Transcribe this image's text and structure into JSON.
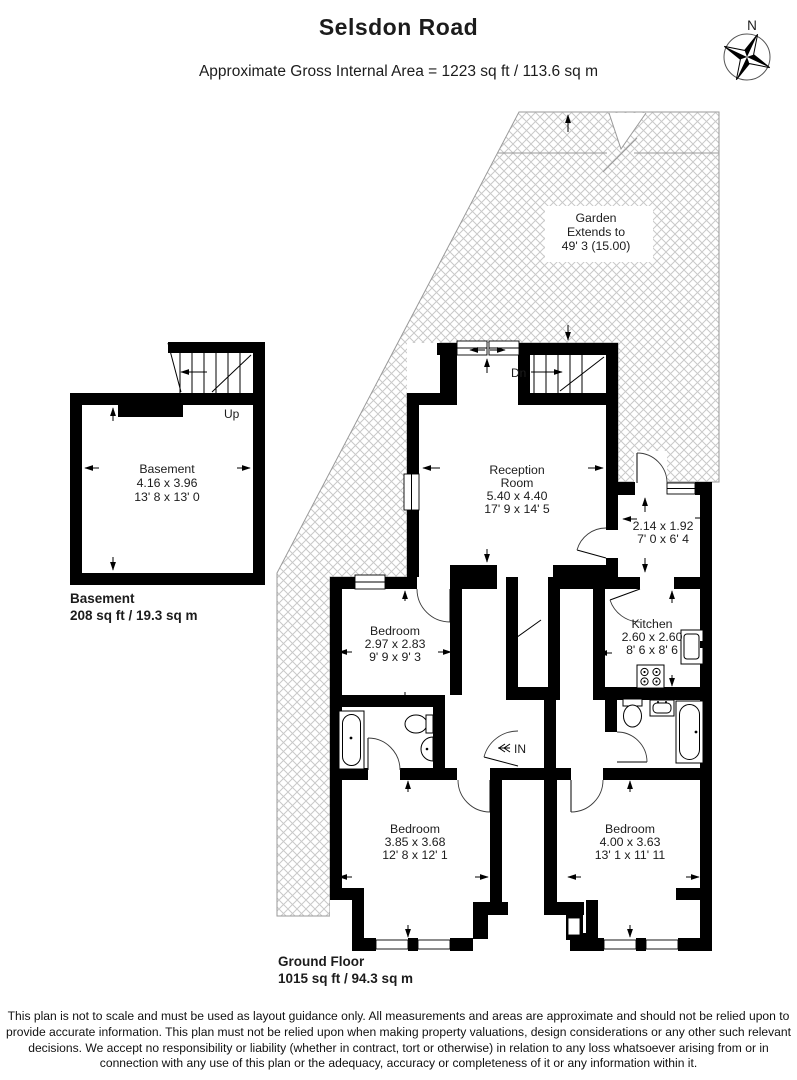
{
  "page": {
    "title": "Selsdon Road",
    "subtitle": "Approximate Gross Internal Area = 1223 sq ft / 113.6 sq m"
  },
  "compass": {
    "north": "N"
  },
  "garden": {
    "line1": "Garden",
    "line2": "Extends to",
    "line3": "49' 3 (15.00)"
  },
  "rooms": {
    "reception": {
      "line1": "Reception",
      "line2": "Room",
      "metric": "5.40 x 4.40",
      "imperial": "17' 9 x 14' 5"
    },
    "hallway": {
      "metric": "2.14 x 1.92",
      "imperial": "7' 0 x 6' 4"
    },
    "kitchen": {
      "name": "Kitchen",
      "metric": "2.60 x 2.60",
      "imperial": "8' 6 x 8' 6"
    },
    "bedroom_mid": {
      "name": "Bedroom",
      "metric": "2.97 x 2.83",
      "imperial": "9' 9 x 9' 3"
    },
    "bedroom_left": {
      "name": "Bedroom",
      "metric": "3.85 x 3.68",
      "imperial": "12' 8 x 12' 1"
    },
    "bedroom_right": {
      "name": "Bedroom",
      "metric": "4.00 x 3.63",
      "imperial": "13' 1 x 11' 11"
    },
    "basement": {
      "name": "Basement",
      "metric": "4.16 x 3.96",
      "imperial": "13' 8 x 13' 0"
    }
  },
  "markers": {
    "up": "Up",
    "down": "Dn",
    "entry": "IN"
  },
  "floors": {
    "basement": {
      "name": "Basement",
      "area": "208 sq ft / 19.3 sq m"
    },
    "ground": {
      "name": "Ground Floor",
      "area": "1015 sq ft / 94.3 sq m"
    }
  },
  "disclaimer": [
    "This plan is not to scale and must be used as layout guidance only. All measurements and areas are approximate and should not be relied upon to",
    "provide accurate information. This plan must not be relied upon when making property valuations, design considerations or any other such relevant",
    "decisions. We accept no responsibility or liability (whether in contract, tort or otherwise) in relation to any loss whatsoever arising from or in",
    "connection with any use of this plan or the adequacy, accuracy or completeness of it or any information within it."
  ],
  "colors": {
    "wall": "#000000",
    "hatch": "#c9c9c9",
    "outline": "#9a9a9a"
  }
}
